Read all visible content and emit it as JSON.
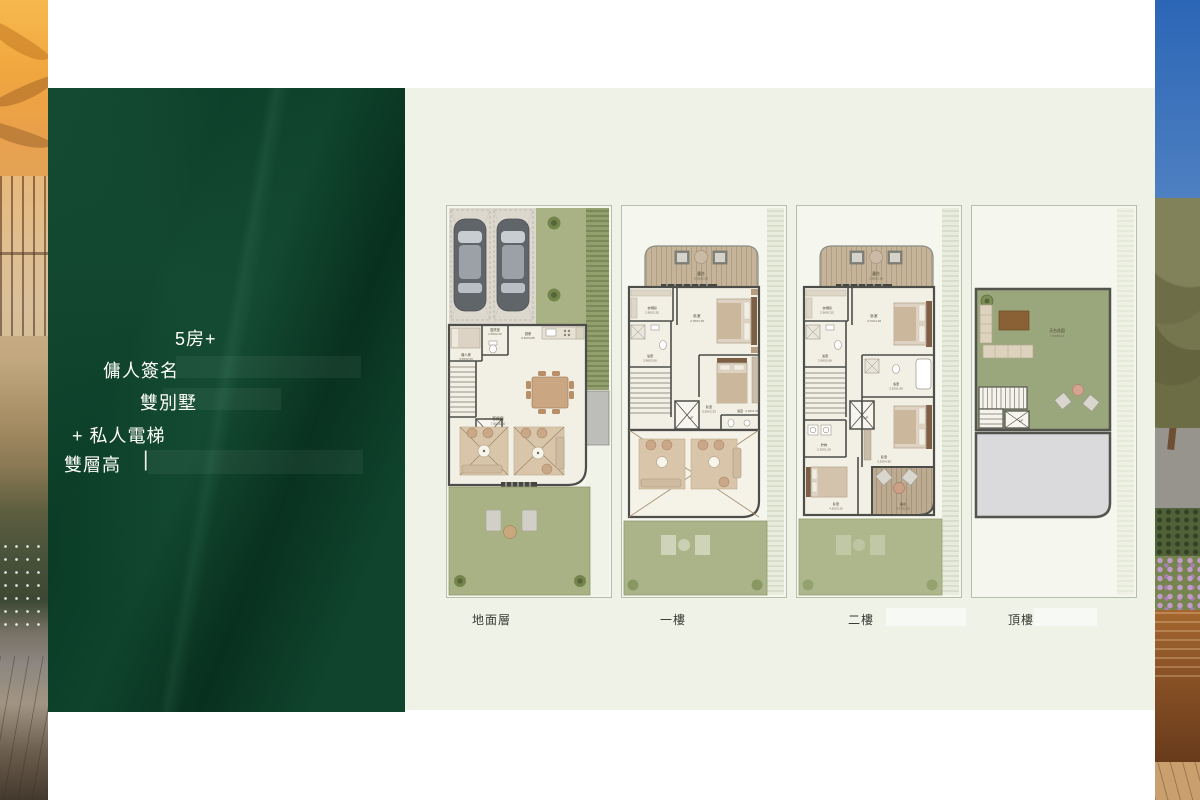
{
  "slide": {
    "panel": {
      "bg": "#0a3b26",
      "lines": [
        "5房+",
        "傭人簽名",
        "雙別墅",
        "+ 私人電梯",
        "雙層高"
      ],
      "cursor": "|"
    },
    "floors": [
      {
        "label": "地面層",
        "rooms": {
          "living": "客飯廳",
          "living_dim": "7.50X8.40",
          "powder": "盥洗室",
          "powder_dim": "1.55X2.20",
          "kitchen": "廚房",
          "kitchen_dim": "3.60X3.85",
          "maid": "傭人房",
          "maid_dim": "3.65X2.60",
          "lift": "L/F"
        }
      },
      {
        "label": "一樓",
        "rooms": {
          "balcony": "露台",
          "balcony_dim": "5.38X2.56",
          "closet": "衣帽間",
          "closet_dim": "1.90X2.25",
          "master": "臥室",
          "master_dim": "4.78X3.35",
          "bath1": "浴室",
          "bath1_dim": "2.90X2.06",
          "bed2": "臥室",
          "bed2_dim": "3.50X2.23",
          "bath2": "浴室",
          "bath2_dim": "2.26X1.50",
          "lift": "L/F"
        }
      },
      {
        "label": "二樓",
        "rooms": {
          "balcony": "露台",
          "balcony_dim": "3.38X2.36",
          "closet": "衣帽間",
          "closet_dim": "2.90X2.25",
          "master": "臥室",
          "master_dim": "4.70X4.20",
          "bath1": "浴室",
          "bath1_dim": "2.90X2.06",
          "bath2": "浴室",
          "bath2_dim": "3.25X1.90",
          "store": "貯物",
          "store_dim": "2.25X1.20",
          "bed3": "臥室",
          "bed3_dim": "3.25X4.30",
          "bed4": "臥室",
          "bed4_dim": "4.20X3.20",
          "terrace": "露台",
          "terrace_dim": "3.17X2.55",
          "lift": "L/F"
        }
      },
      {
        "label": "頂樓",
        "rooms": {
          "roof_garden": "天台花園",
          "roof_garden_dim": "7.50X8.10",
          "lift": "L/F"
        }
      }
    ]
  },
  "colors": {
    "panel_green": "#0a3b26",
    "plan_area_bg": "#eef2e7",
    "garden_green": "#a9b284",
    "wall": "#4d4e49",
    "deck_wood": "#c6b49a",
    "roof_gray": "#dadadd"
  }
}
